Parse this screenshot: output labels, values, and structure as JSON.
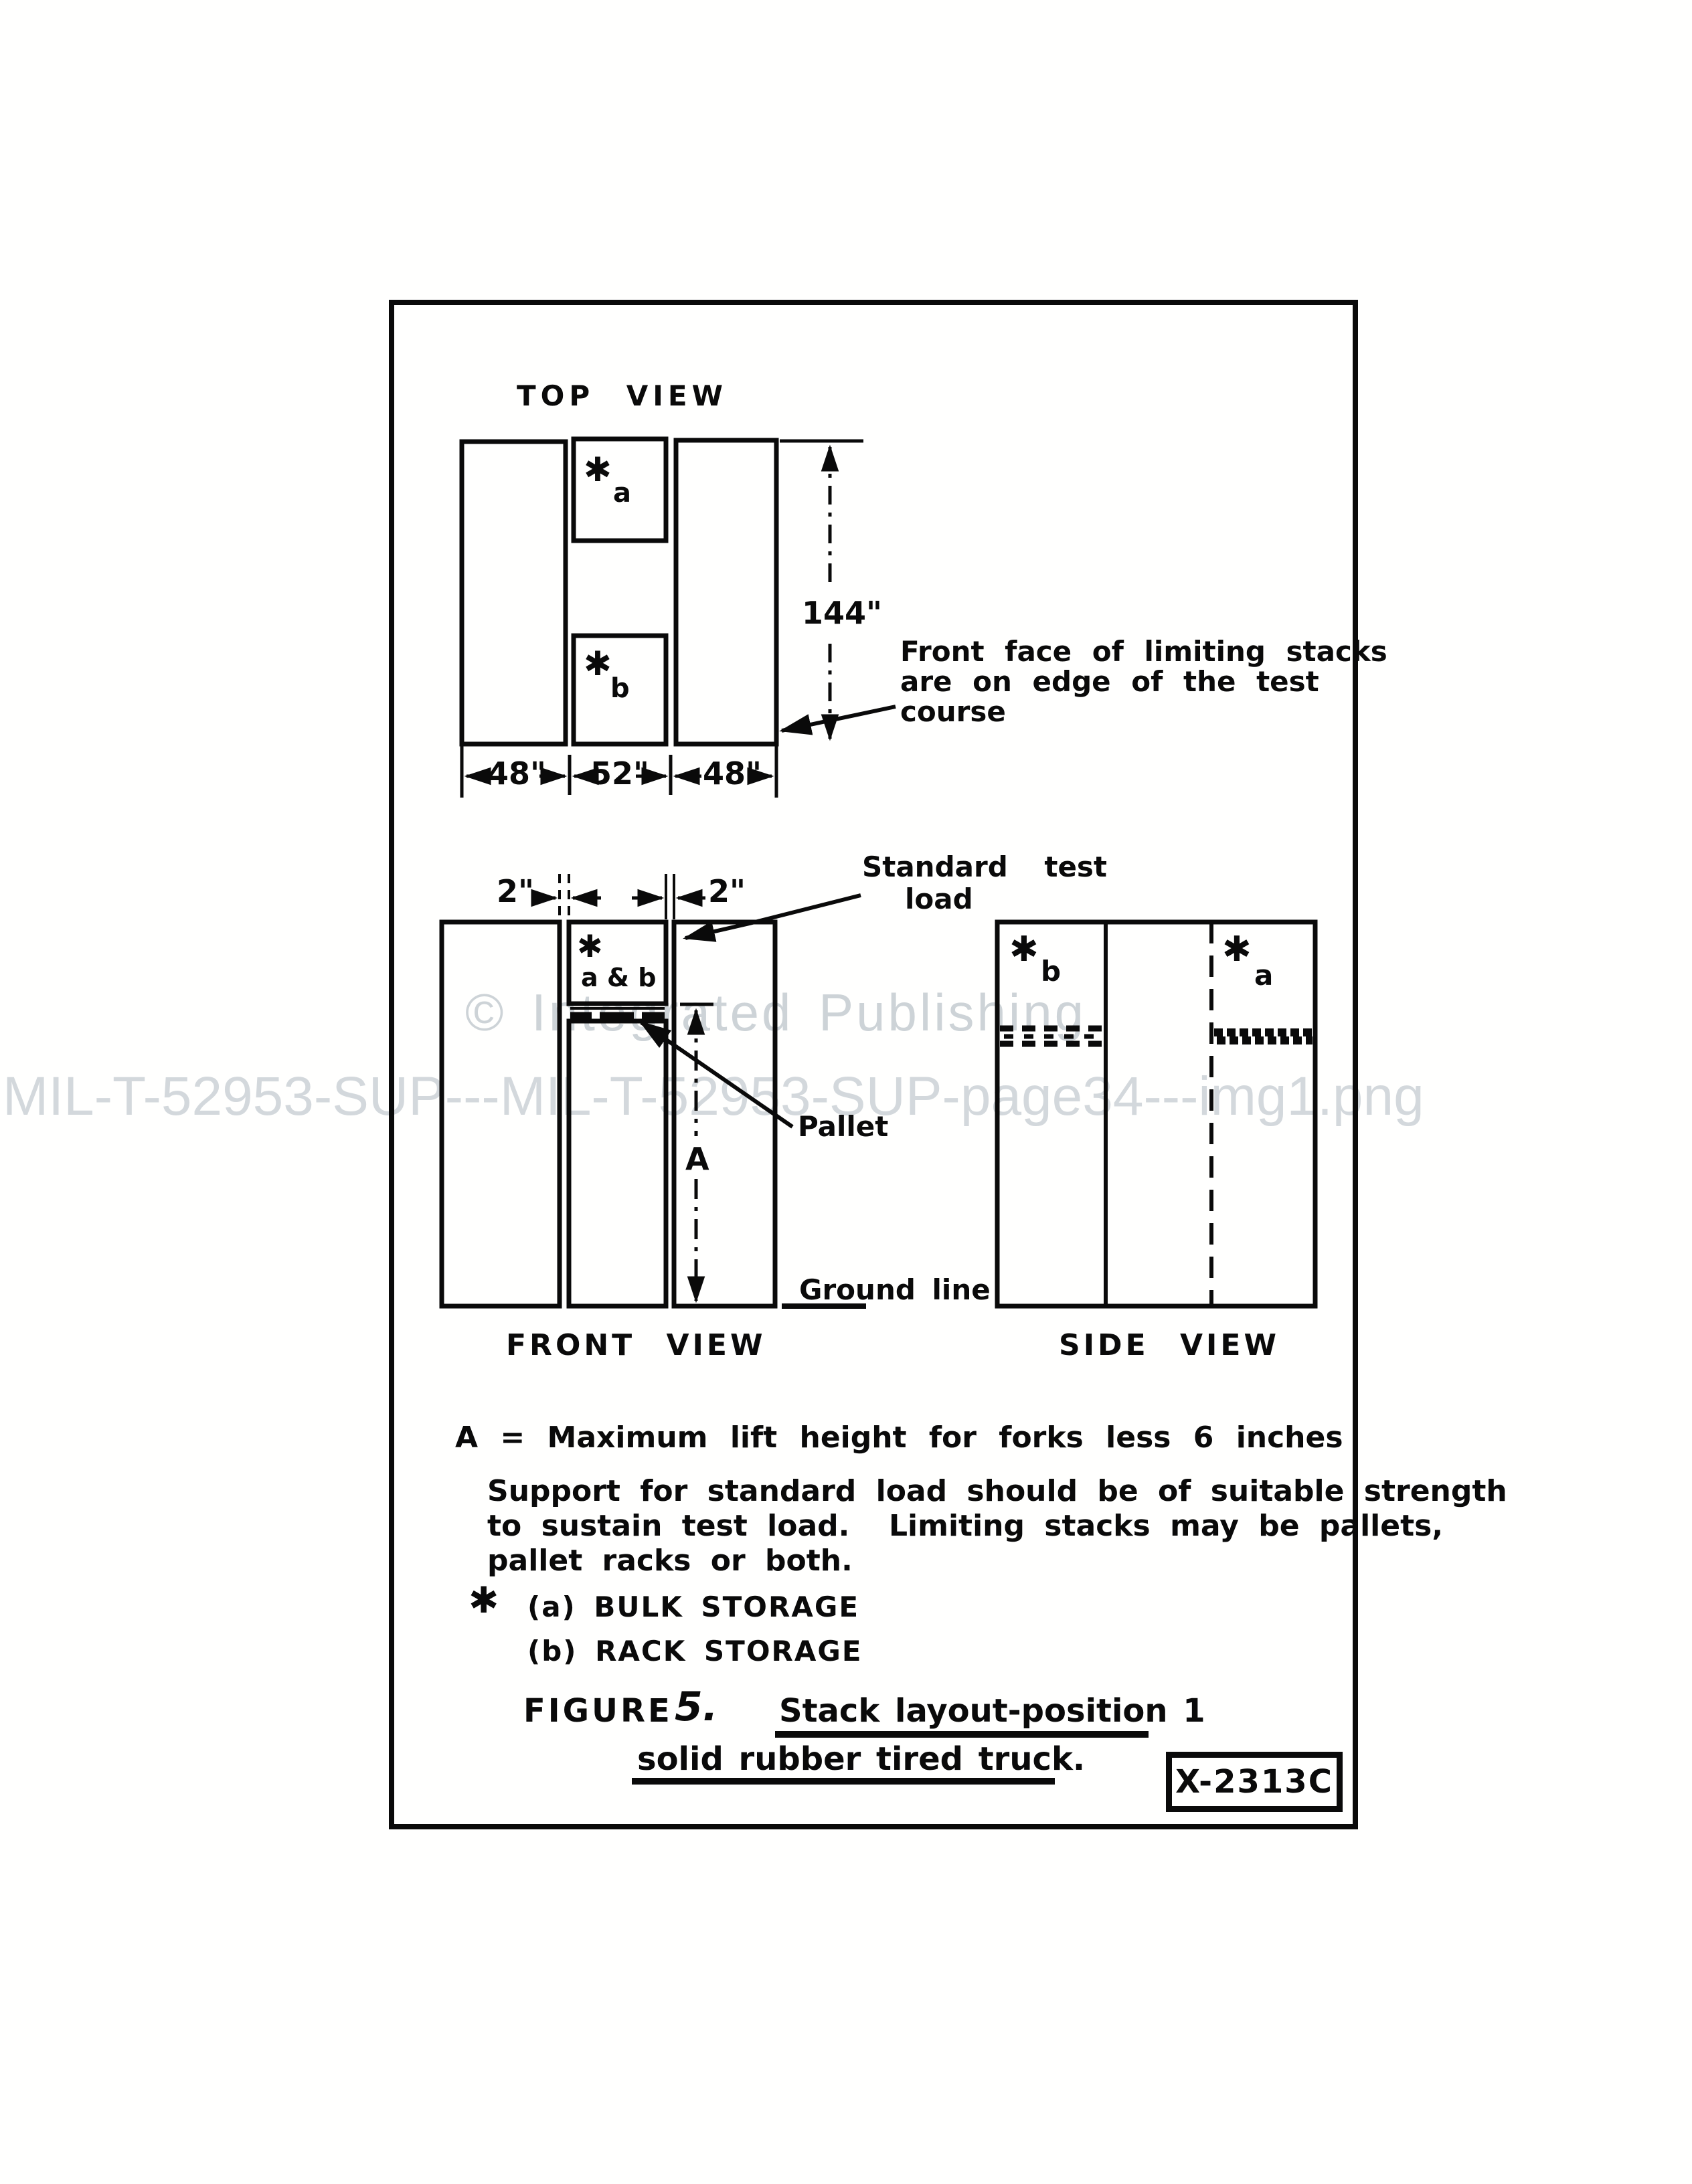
{
  "watermarks": {
    "copyright": "© Integrated Publishing",
    "filename": "MIL-T-52953-SUP---MIL-T-52953-SUP-page34---img1.png"
  },
  "figure": {
    "top_view": {
      "title": "TOP VIEW",
      "star": "✱",
      "stack_a_label": "a",
      "stack_b_label": "b",
      "dims": {
        "left": "48\"",
        "middle": "52\"",
        "right": "48\"",
        "depth": "144\""
      },
      "annotation_lines": [
        "Front face of limiting stacks",
        "are on edge of the test",
        "course"
      ]
    },
    "front_view": {
      "title": "FRONT VIEW",
      "gap_left": "2\"",
      "gap_right": "2\"",
      "star": "✱",
      "load_box_label": "a & b",
      "standard_test_load_lines": [
        "Standard test",
        "load"
      ],
      "pallet_label": "Pallet",
      "lift_height_label": "A",
      "ground_line_label": "Ground line"
    },
    "side_view": {
      "title": "SIDE VIEW",
      "star": "✱",
      "stack_b_label": "b",
      "stack_a_label": "a"
    },
    "notes": {
      "lift_height_note": "A = Maximum lift height for forks less 6 inches",
      "support_note_lines": [
        "Support for standard load should be of suitable strength",
        "to sustain test load.  Limiting stacks may be pallets,",
        "pallet racks or both."
      ],
      "legend_star": "✱",
      "legend_a": "(a) BULK STORAGE",
      "legend_b": "(b) RACK STORAGE"
    },
    "caption": {
      "figure_word": "FIGURE",
      "figure_number": "5.",
      "title_line1": "Stack layout-position 1",
      "title_line2": "solid rubber tired truck."
    },
    "stamp": "X-2313C"
  }
}
